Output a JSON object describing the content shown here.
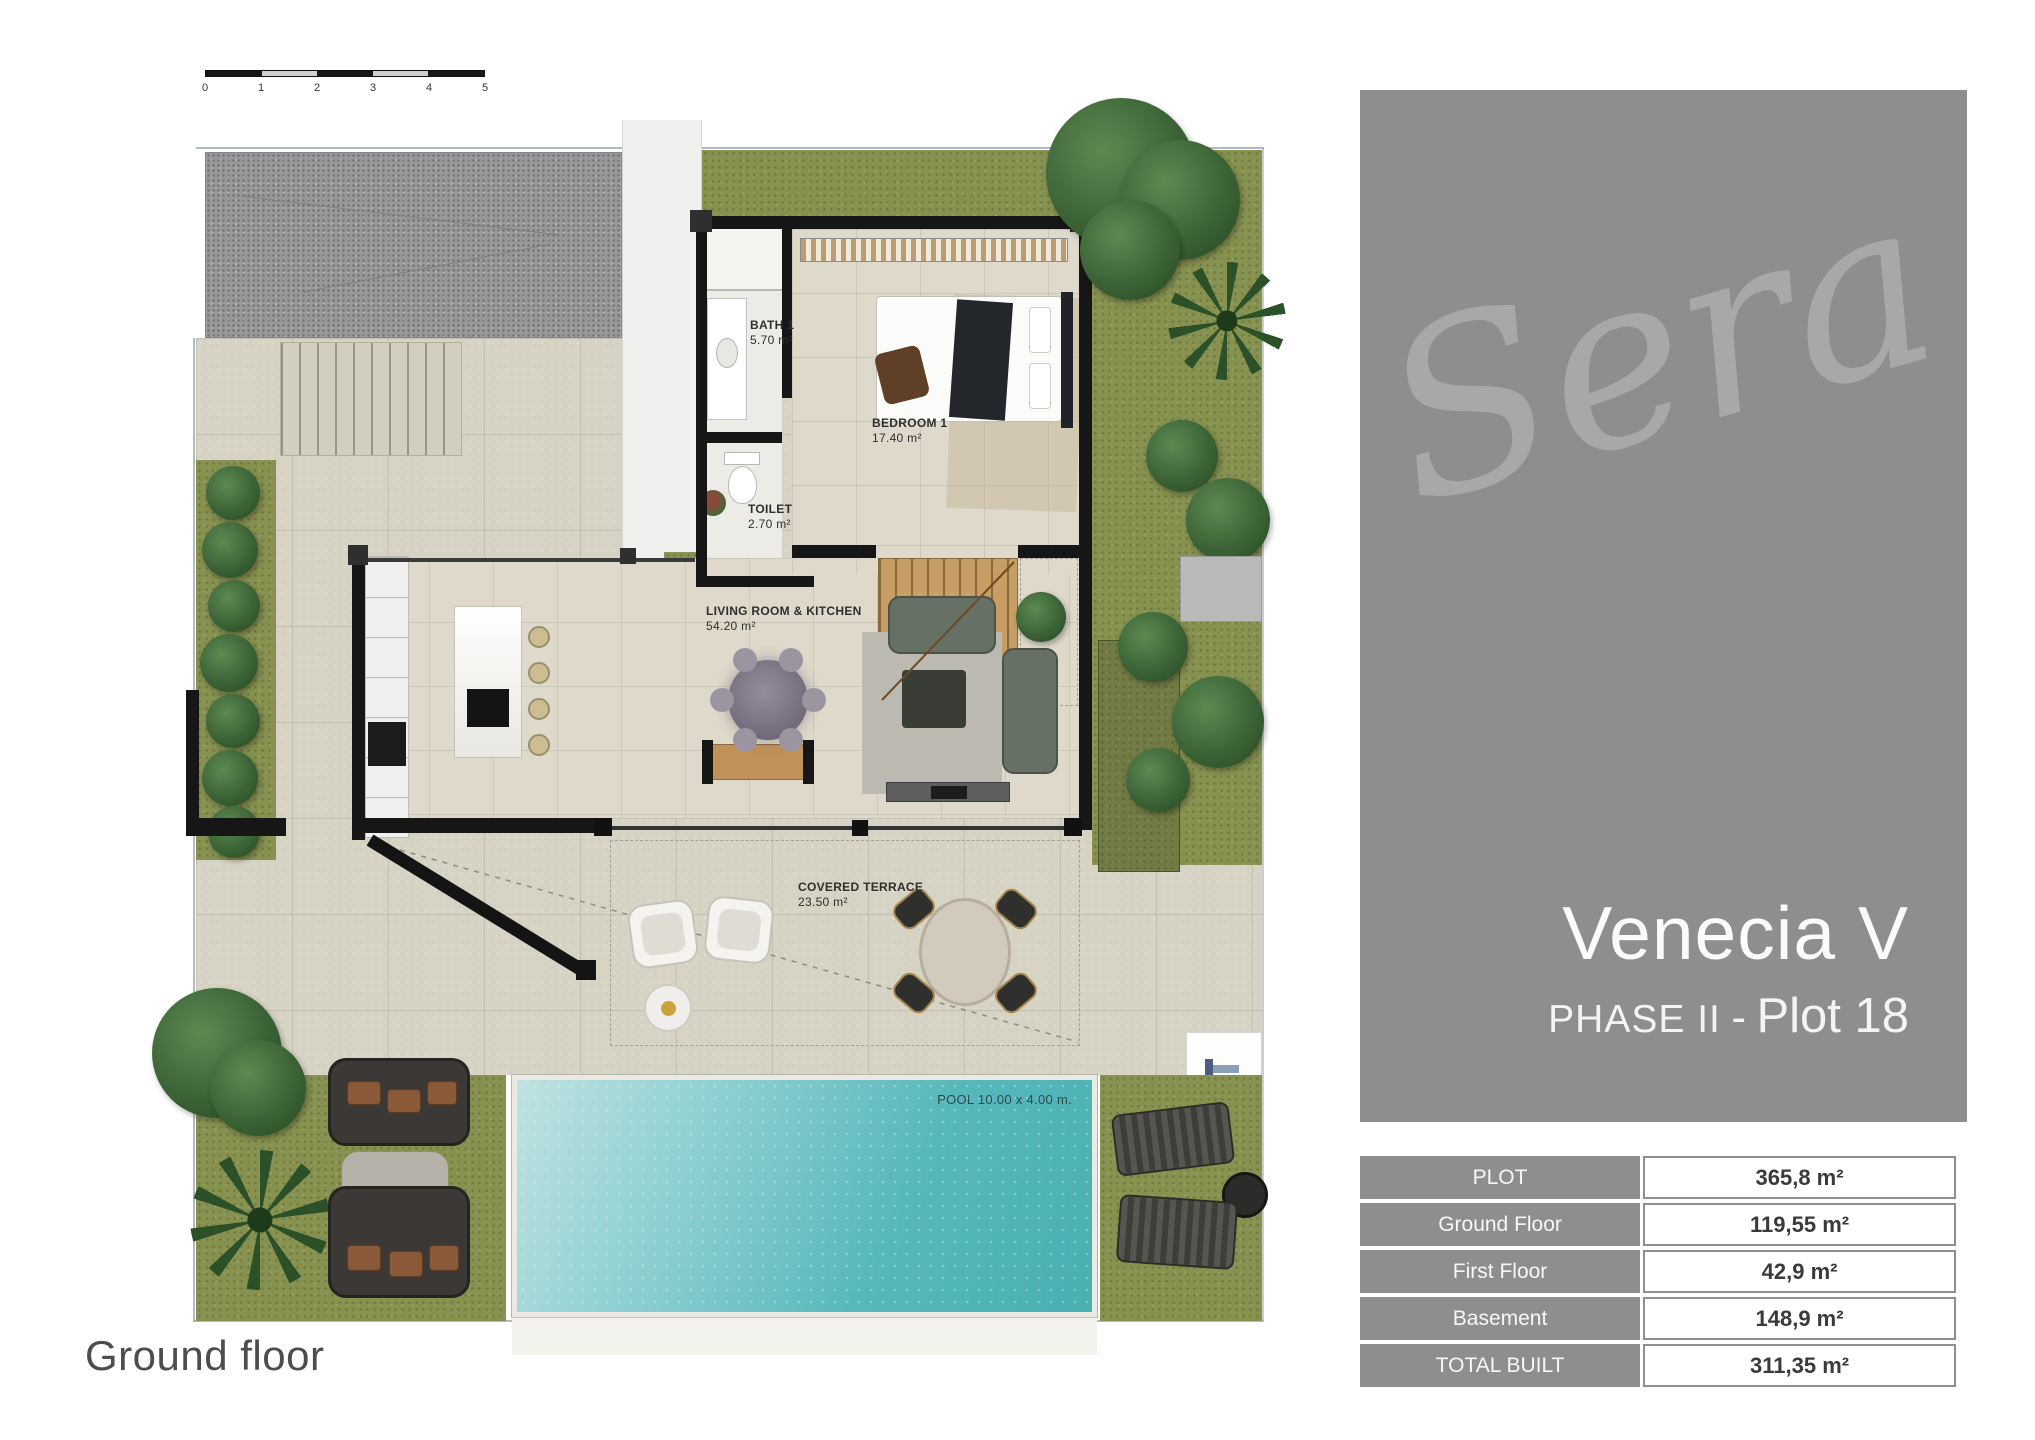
{
  "page": {
    "caption": "Ground floor"
  },
  "scalebar": {
    "labels": [
      "0",
      "1",
      "2",
      "3",
      "4",
      "5"
    ]
  },
  "rooms": {
    "bath": {
      "name": "BATH 1",
      "area": "5.70 m²"
    },
    "bedroom": {
      "name": "BEDROOM 1",
      "area": "17.40 m²"
    },
    "toilet": {
      "name": "TOILET",
      "area": "2.70 m²"
    },
    "living": {
      "name": "LIVING ROOM & KITCHEN",
      "area": "54.20 m²"
    },
    "terrace": {
      "name": "COVERED TERRACE",
      "area": "23.50 m²"
    },
    "pool": {
      "label": "POOL 10.00 x 4.00 m."
    }
  },
  "brand": {
    "logo": "Sera"
  },
  "project": {
    "title": "Venecia V",
    "phase": "PHASE II",
    "separator": "-",
    "plot": "Plot 18"
  },
  "areas_table": {
    "rows": [
      {
        "label": "PLOT",
        "value": "365,8 m²"
      },
      {
        "label": "Ground Floor",
        "value": "119,55 m²"
      },
      {
        "label": "First Floor",
        "value": "42,9 m²"
      },
      {
        "label": "Basement",
        "value": "148,9 m²"
      },
      {
        "label": "TOTAL BUILT",
        "value": "311,35 m²"
      }
    ]
  },
  "colors": {
    "panel_gray": "#8e8e8e",
    "logo_gray": "#a8a8a8",
    "pool_teal": "#58b7ba",
    "grass_green": "#879150",
    "paving_beige": "#d6d2c4",
    "wall_black": "#161616"
  }
}
